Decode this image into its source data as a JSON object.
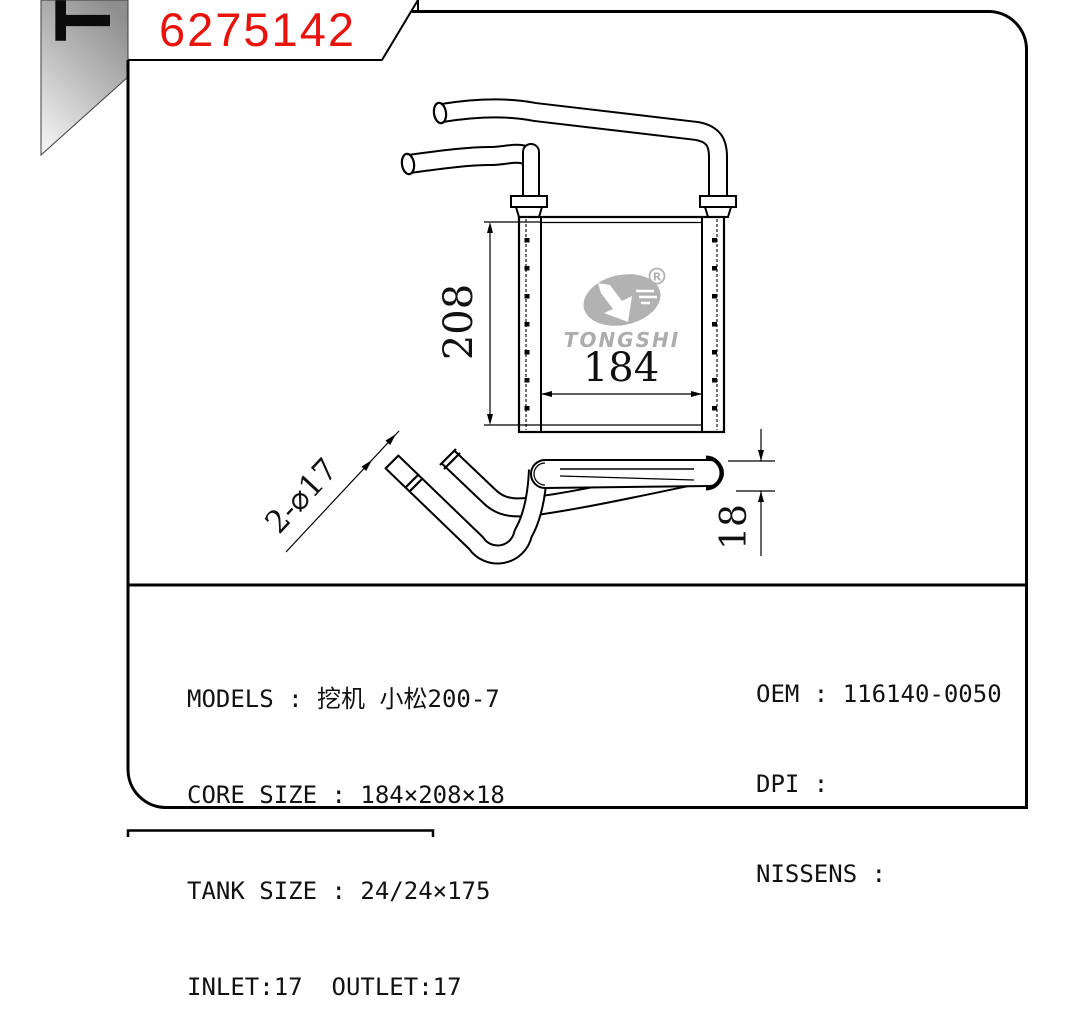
{
  "frame": {
    "background": "#ffffff",
    "line_color": "#000000"
  },
  "title_block": {
    "part_number": "6275142",
    "part_number_color": "#e8140c",
    "corner_letter": "T"
  },
  "logo": {
    "brand": "TONGSHI",
    "registered_mark": "R",
    "color": "#b2b2b2"
  },
  "dimensions": {
    "core_height": "208",
    "core_width": "184",
    "core_depth": "18",
    "pipe_note": "2-⌀17"
  },
  "specs": {
    "left": [
      "MODELS : 挖机 小松200-7",
      "CORE SIZE : 184×208×18",
      "TANK SIZE : 24/24×175",
      "INLET:17  OUTLET:17"
    ],
    "right": [
      "OEM : 116140-0050",
      "DPI :",
      "NISSENS :"
    ]
  }
}
